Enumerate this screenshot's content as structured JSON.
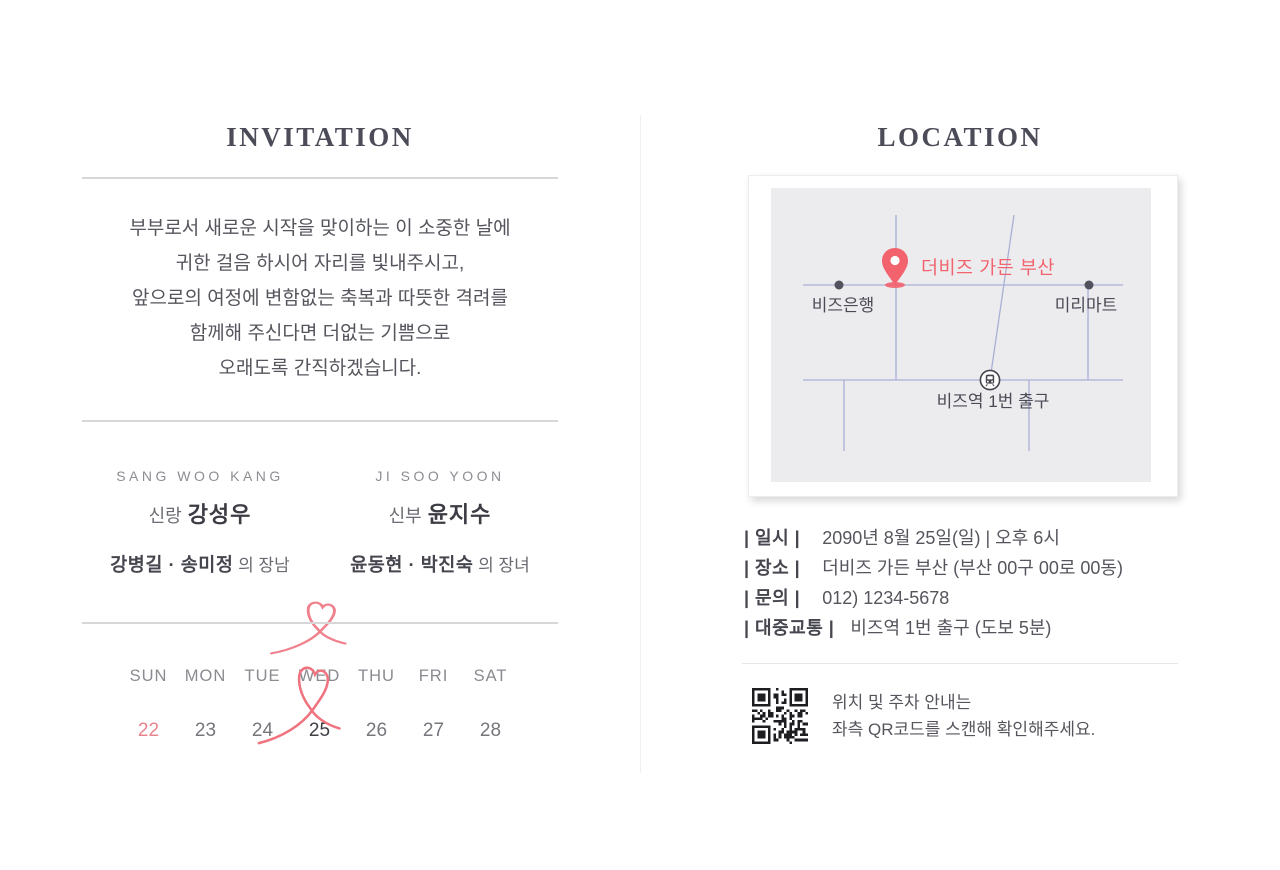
{
  "invitation": {
    "title": "INVITATION",
    "message": "부부로서 새로운 시작을 맞이하는 이 소중한 날에\n귀한 걸음 하시어 자리를 빛내주시고,\n앞으로의 여정에 변함없는 축복과 따뜻한 격려를\n함께해 주신다면 더없는 기쁨으로\n오래도록 간직하겠습니다.",
    "groom": {
      "en": "SANG WOO KANG",
      "role": "신랑",
      "name": "강성우",
      "parents": "강병길 · 송미정",
      "parents_suffix": " 의 장남"
    },
    "bride": {
      "en": "JI SOO YOON",
      "role": "신부",
      "name": "윤지수",
      "parents": "윤동현 · 박진숙",
      "parents_suffix": " 의 장녀"
    },
    "calendar": {
      "headers": [
        "SUN",
        "MON",
        "TUE",
        "WED",
        "THU",
        "FRI",
        "SAT"
      ],
      "days": [
        "22",
        "23",
        "24",
        "25",
        "26",
        "27",
        "28"
      ],
      "highlighted_day": "25",
      "holiday_day": "22"
    }
  },
  "location": {
    "title": "LOCATION",
    "map": {
      "venue": "더비즈 가든 부산",
      "landmark_left": "비즈은행",
      "landmark_right": "미리마트",
      "station": "비즈역 1번 출구"
    },
    "details": [
      {
        "label": "| 일시 |",
        "value": "2090년 8월 25일(일)  |  오후 6시"
      },
      {
        "label": "| 장소 |",
        "value": "더비즈 가든 부산 (부산 00구 00로 00동)"
      },
      {
        "label": "| 문의 |",
        "value": "012) 1234-5678"
      },
      {
        "label": "| 대중교통 |",
        "value": "비즈역 1번 출구 (도보 5분)"
      }
    ],
    "qr_note": "위치 및 주차 안내는\n좌측 QR코드를 스캔해 확인해주세요."
  },
  "colors": {
    "accent_coral": "#f2636e",
    "heart_pink": "#f0818c",
    "title_slate": "#4c4c59",
    "road_blue": "#a9b0d4",
    "map_bg": "#ececef"
  }
}
